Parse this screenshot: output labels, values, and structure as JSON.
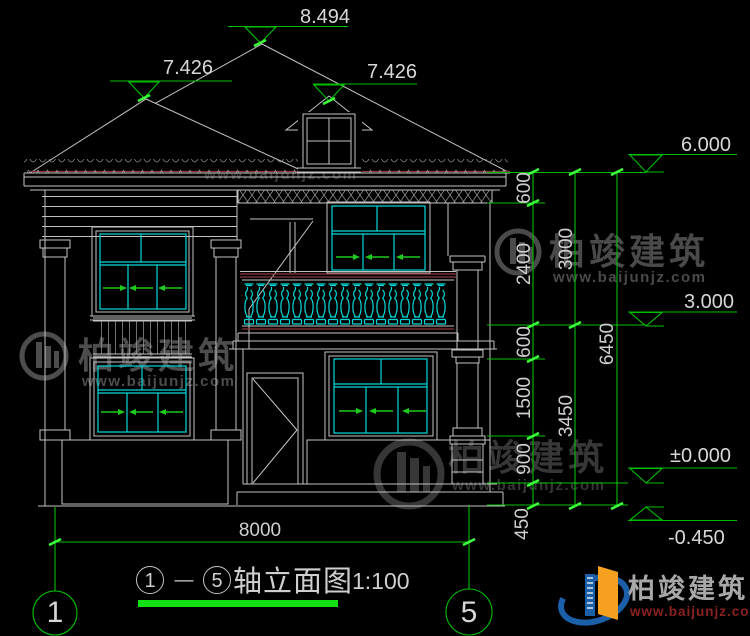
{
  "drawing": {
    "levels": {
      "ridge": "8.494",
      "hip_left": "7.426",
      "hip_right": "7.426",
      "eave": "6.000",
      "floor2": "3.000",
      "ground": "±0.000",
      "grade": "-0.450"
    },
    "dimensions": {
      "col1": [
        "600",
        "2400",
        "600",
        "1500",
        "900",
        "450"
      ],
      "col2": [
        "3000",
        "3450"
      ],
      "col3": [
        "6450"
      ],
      "overall_width": "8000"
    },
    "axis_bubbles": {
      "left": "1",
      "right": "5"
    },
    "title": {
      "axis_start": "1",
      "dash": "—",
      "axis_end": "5",
      "name": "轴立面图",
      "scale": "1:100"
    },
    "colors": {
      "background": "#000000",
      "line_white": "#c3c3c3",
      "frame_cyan": "#00d8d8",
      "dimension_green": "#00bf00",
      "rail_red": "#8b3838",
      "logo_blue": "#1a5fa8",
      "logo_orange": "#f6a020",
      "logo_red": "#8b2121"
    }
  },
  "watermark": {
    "brand": "柏竣建筑",
    "site": "www.baijunjz.com"
  },
  "footer_logo": {
    "brand": "柏竣建筑",
    "site": "www.baijunjz.com"
  }
}
